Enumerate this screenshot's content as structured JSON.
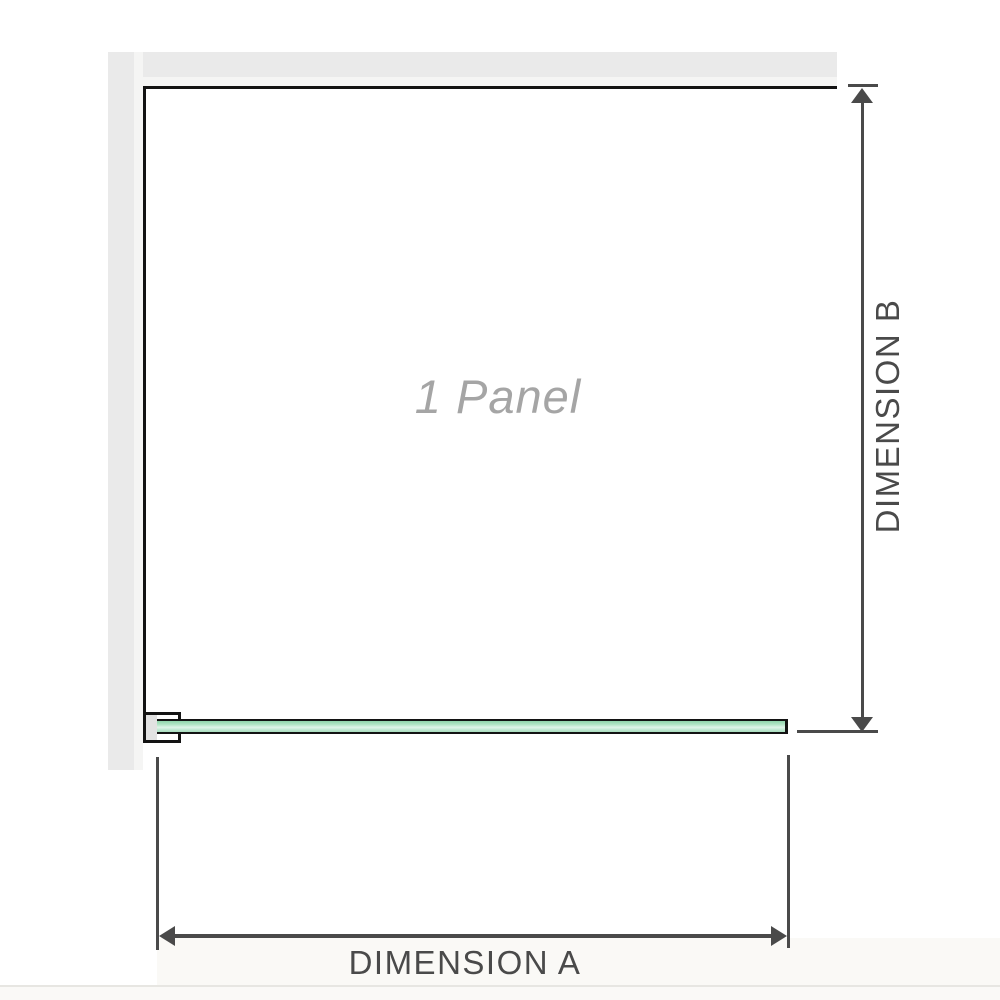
{
  "diagram": {
    "panel_label": "1 Panel",
    "dimension_a": {
      "label": "DIMENSION A",
      "orientation": "horizontal"
    },
    "dimension_b": {
      "label": "DIMENSION B",
      "orientation": "vertical"
    },
    "colors": {
      "wall_gray": "#eaeaea",
      "wall_highlight": "#f5f5f4",
      "outline_black": "#131313",
      "dimension_gray": "#4a4a4a",
      "glass_green": "#8fd4aa",
      "glass_green_light": "#e0f4e9",
      "panel_label_gray": "#a5a5a5"
    }
  }
}
